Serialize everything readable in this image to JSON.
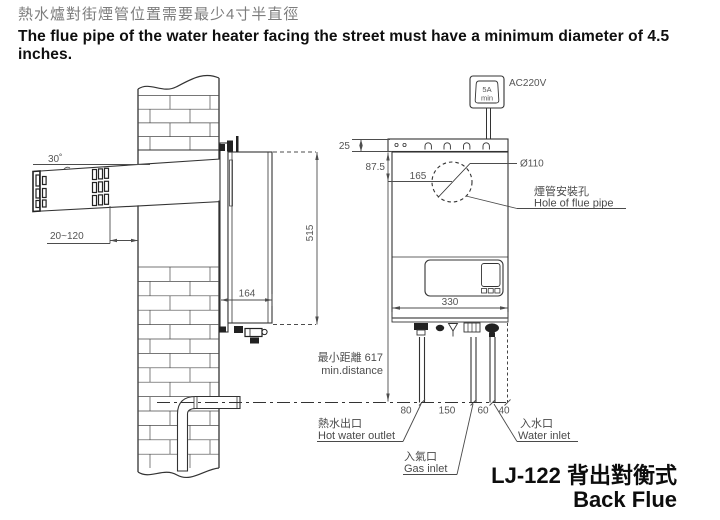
{
  "title": {
    "zh": "熱水爐對街煙管位置需要最少4寸半直徑",
    "en": "The flue pipe of the water heater facing the street must have a minimum diameter of 4.5 inches."
  },
  "power": {
    "amp": "5A",
    "amp_min": "min",
    "voltage": "AC220V"
  },
  "dims": {
    "angle": "30˚",
    "protrusion": "20~120",
    "depth": "164",
    "height": "515",
    "top_gap": "25",
    "flue_from_top": "87.5",
    "flue_from_left": "165",
    "flue_dia": "Ø110",
    "width": "330",
    "min_dist_zh": "最小距離 617",
    "min_dist_en": "min.distance",
    "d80": "80",
    "d150": "150",
    "d60": "60",
    "d40": "40"
  },
  "labels": {
    "flue_hole_zh": "煙管安裝孔",
    "flue_hole_en": "Hole of flue pipe",
    "hot_zh": "熱水出口",
    "hot_en": "Hot water outlet",
    "gas_zh": "入氣口",
    "gas_en": "Gas inlet",
    "water_zh": "入水口",
    "water_en": "Water inlet"
  },
  "model": {
    "zh": "LJ-122 背出對衡式",
    "en": "Back Flue"
  },
  "colors": {
    "line": "#333333",
    "dim": "#4d4d4d",
    "title_zh": "#7d7d7d",
    "text": "#111111"
  }
}
